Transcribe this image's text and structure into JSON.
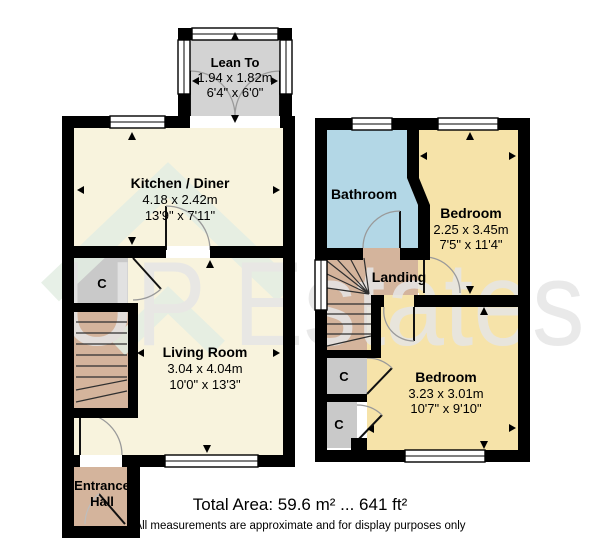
{
  "colors": {
    "wall": "#000000",
    "room_cream": "#f8f3dd",
    "room_yellow": "#f6e3a9",
    "bathroom_blue": "#b3d7e6",
    "circulation_tan": "#d4b49c",
    "cupboard_gray": "#c9c9c9",
    "leanto_gray": "#d3d3d3",
    "watermark_green": "#e3eee3"
  },
  "ground_floor": {
    "lean_to": {
      "name": "Lean To",
      "metric": "1.94 x 1.82m",
      "imperial": "6'4\" x 6'0\""
    },
    "kitchen": {
      "name": "Kitchen / Diner",
      "metric": "4.18 x 2.42m",
      "imperial": "13'9\" x 7'11\""
    },
    "living_room": {
      "name": "Living Room",
      "metric": "3.04 x 4.04m",
      "imperial": "10'0\" x 13'3\""
    },
    "entrance_hall": {
      "name_line1": "Entrance",
      "name_line2": "Hall"
    },
    "cupboard_label": "C"
  },
  "first_floor": {
    "bathroom": {
      "name": "Bathroom"
    },
    "bedroom_rear": {
      "name": "Bedroom",
      "metric": "2.25 x 3.45m",
      "imperial": "7'5\" x 11'4\""
    },
    "landing": {
      "name": "Landing"
    },
    "bedroom_front": {
      "name": "Bedroom",
      "metric": "3.23 x 3.01m",
      "imperial": "10'7\" x 9'10\""
    },
    "cupboard1_label": "C",
    "cupboard2_label": "C"
  },
  "footer": {
    "total_area": "Total Area: 59.6 m² ... 641 ft²",
    "disclaimer": "All measurements are approximate and for display purposes only"
  },
  "watermark_text": "UP Estates"
}
